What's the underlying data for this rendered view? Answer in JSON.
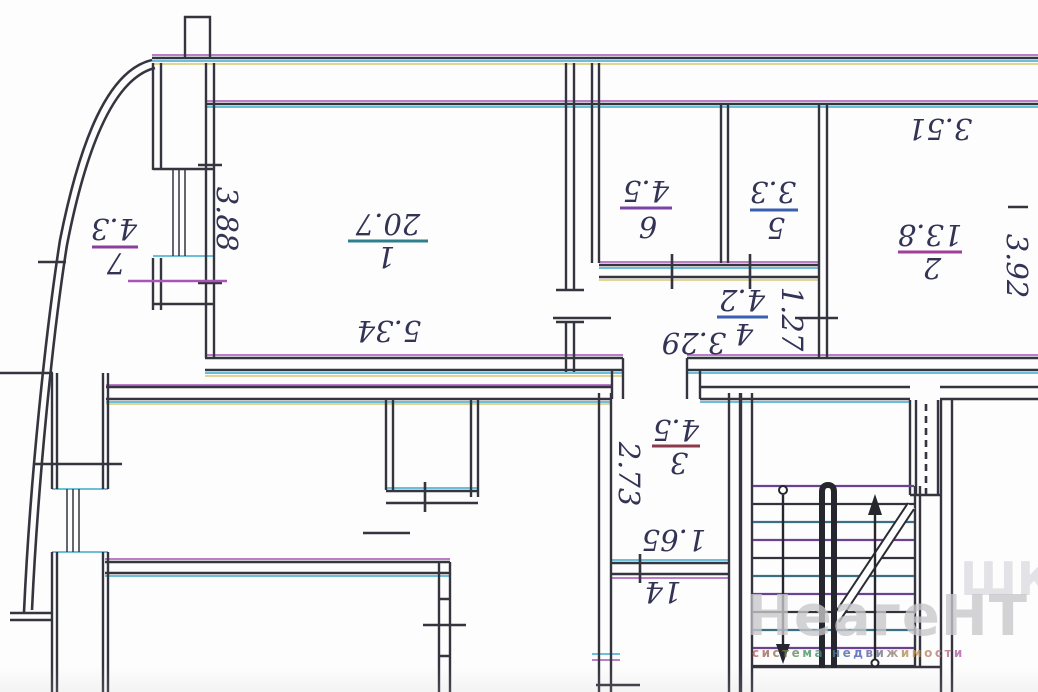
{
  "colors": {
    "ink": "#35353f",
    "cyan": "#55b8d4",
    "magenta": "#a855b8",
    "yellow": "#d6c870",
    "blue": "#3a5fb0",
    "label": "#333356",
    "watermark": "#c8c8cc"
  },
  "rooms": [
    {
      "number": "7",
      "area": "4.3"
    },
    {
      "number": "1",
      "area": "20.7"
    },
    {
      "number": "6",
      "area": "4.5"
    },
    {
      "number": "5",
      "area": "3.3"
    },
    {
      "number": "4",
      "area": "4.2"
    },
    {
      "number": "2",
      "area": "13.8"
    },
    {
      "number": "3",
      "area": "4.5"
    },
    {
      "number": "14",
      "area": ""
    }
  ],
  "dimensions": {
    "balcony_depth": "3.88",
    "room1_width": "5.34",
    "room2_width": "3.51",
    "room2_depth": "3.92",
    "hall_width": "3.29",
    "hall_depth": "1.27",
    "corridor_depth": "2.73",
    "corridor_width": "1.65"
  },
  "watermark": {
    "brand": "НеагеНТ",
    "tagline": "система недвижимости",
    "fragment": "ШК"
  }
}
